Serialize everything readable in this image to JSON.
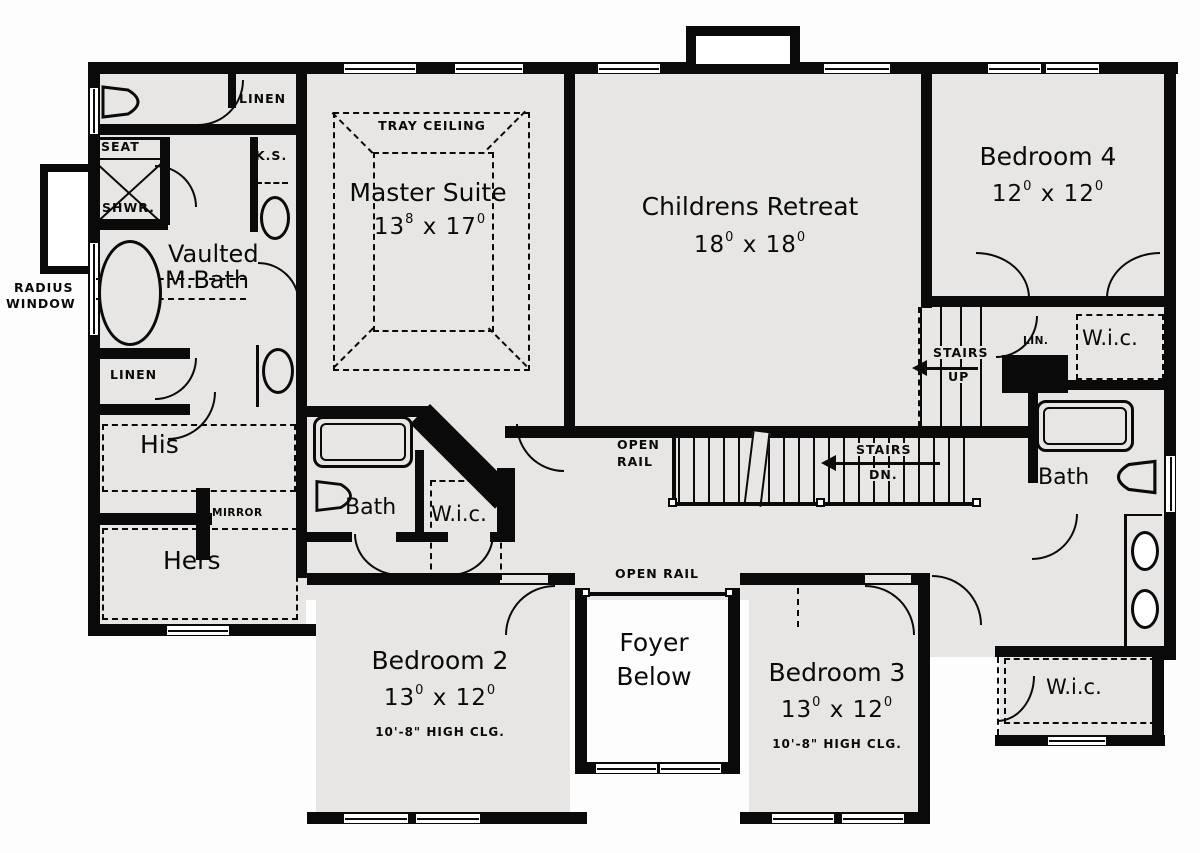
{
  "palette": {
    "wall": "#0a0a0a",
    "floor": "#e7e6e4",
    "background": "#ffffff"
  },
  "rooms": {
    "master": {
      "name": "Master Suite",
      "d1": "13",
      "s1": "8",
      "x": "x",
      "d2": "17",
      "s2": "0",
      "ceiling": "TRAY CEILING"
    },
    "childrens": {
      "name": "Childrens Retreat",
      "d1": "18",
      "s1": "0",
      "x": "x",
      "d2": "18",
      "s2": "0"
    },
    "bedroom4": {
      "name": "Bedroom 4",
      "d1": "12",
      "s1": "0",
      "x": "x",
      "d2": "12",
      "s2": "0"
    },
    "bedroom2": {
      "name": "Bedroom 2",
      "d1": "13",
      "s1": "0",
      "x": "x",
      "d2": "12",
      "s2": "0",
      "note": "10'-8\" HIGH CLG."
    },
    "bedroom3": {
      "name": "Bedroom 3",
      "d1": "13",
      "s1": "0",
      "x": "x",
      "d2": "12",
      "s2": "0",
      "note": "10'-8\" HIGH CLG."
    },
    "foyer": {
      "line1": "Foyer",
      "line2": "Below"
    },
    "mbath": {
      "line1": "Vaulted",
      "line2": "M.Bath"
    },
    "bath_mid": {
      "name": "Bath"
    },
    "bath_right": {
      "name": "Bath"
    },
    "his": {
      "name": "His"
    },
    "hers": {
      "name": "Hers"
    }
  },
  "labels": {
    "linen_top": "LINEN",
    "linen_mid": "LINEN",
    "lin_small": "LIN.",
    "seat": "SEAT",
    "shwr": "SHWR.",
    "ks": "K.S.",
    "mirror": "MIRROR",
    "wic_mid": "W.i.c.",
    "wic_top_right": "W.i.c.",
    "wic_bottom_right": "W.i.c.",
    "radius_window_1": "RADIUS",
    "radius_window_2": "WINDOW",
    "open_rail_stairs_1": "OPEN",
    "open_rail_stairs_2": "RAIL",
    "open_rail_foyer": "OPEN RAIL",
    "stairs_up_1": "STAIRS",
    "stairs_up_2": "UP",
    "stairs_dn_1": "STAIRS",
    "stairs_dn_2": "DN."
  }
}
